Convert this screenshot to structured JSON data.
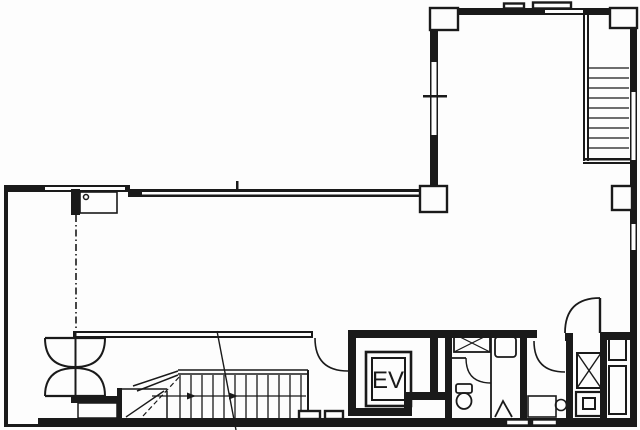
{
  "floorplan": {
    "type": "architectural-floor-plan",
    "elevator": {
      "label": "EV"
    },
    "rooms": {
      "elevator_shaft": "EV",
      "toilet": "",
      "kitchenette": "",
      "main_room": ""
    },
    "colors": {
      "ink": "#1a1a1a",
      "paper": "#fdfdfd"
    }
  }
}
